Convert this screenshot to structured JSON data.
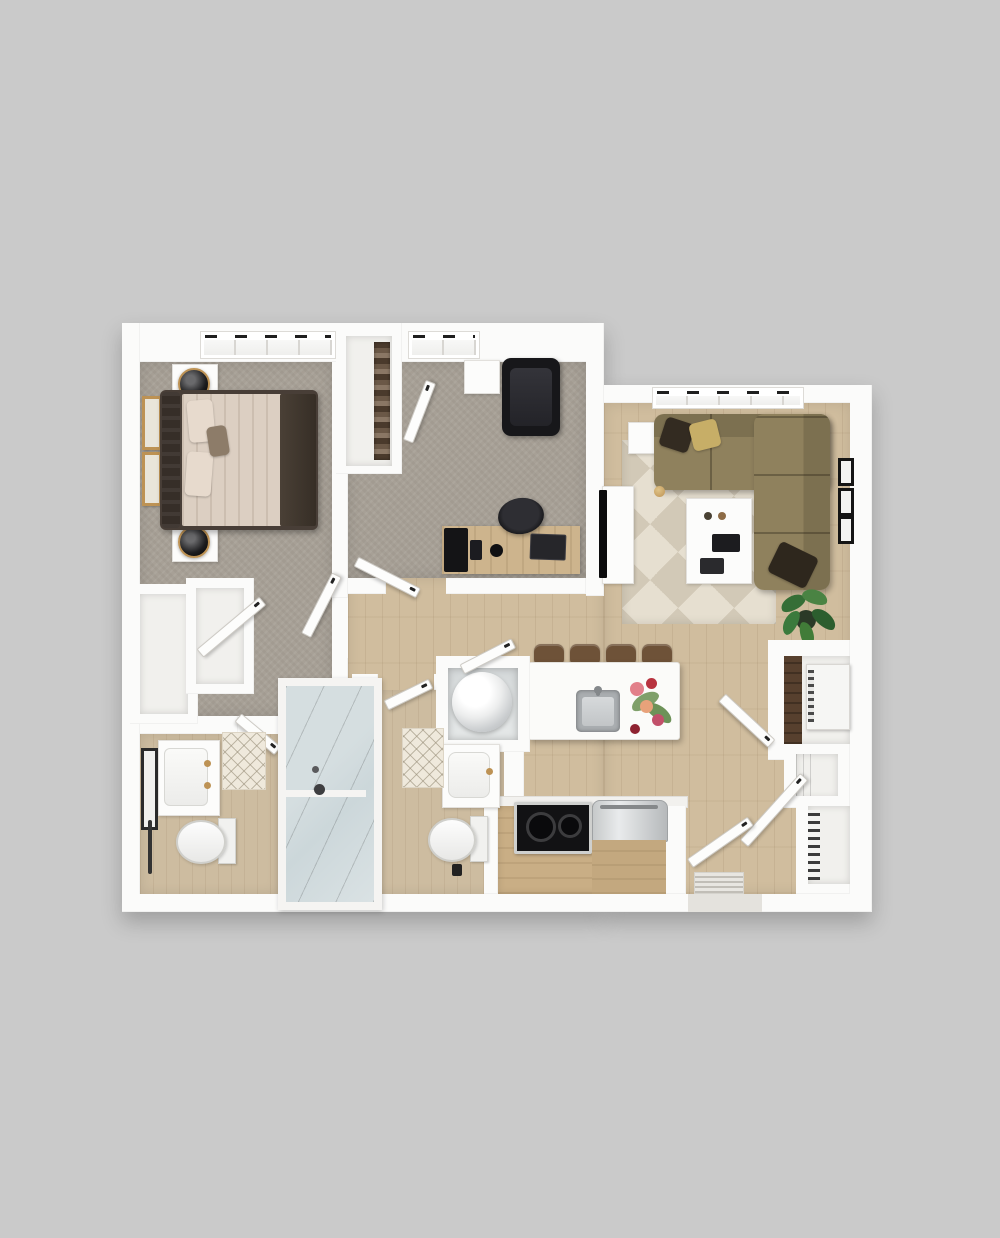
{
  "scene": {
    "description": "3D top-down rendering of a two-bedroom apartment floor plan on a gray background",
    "background": "#cacaca"
  },
  "colors": {
    "bg": "#cacaca",
    "wall": "#fbfbfa",
    "carpet": "#a7a096",
    "wood": "#d0bd9e",
    "woodBath": "#cdbca0",
    "glass": "#ccd7da",
    "rugA": "#d2c9b7",
    "rugB": "#e6dfd0",
    "sofa": "#8f815d",
    "sofaBack": "#7c7050",
    "pillowGold": "#c7ae67",
    "pillowDark": "#332b21",
    "bedFrame": "#483e37",
    "duvet": "#dccfc2",
    "pillow": "#e7dacd",
    "gold": "#bd9254",
    "dark": "#17171a",
    "steel": "#c3c6c8",
    "woodFurn": "#cdb48d",
    "stool": "#6e5238",
    "cabinetWood": "#c9ae85",
    "plant": "#3b7a3c",
    "doorFace": "#fdfdfc",
    "doorEdge": "#cdcac4",
    "interiorCloset": "#f1f0ed"
  },
  "rooms": [
    {
      "id": "bedroom",
      "name": "Bedroom",
      "floor": "carpet"
    },
    {
      "id": "office",
      "name": "Office / Bedroom 2",
      "floor": "carpet"
    },
    {
      "id": "living-room",
      "name": "Living Room",
      "floor": "hardwood"
    },
    {
      "id": "kitchen",
      "name": "Kitchen",
      "floor": "hardwood"
    },
    {
      "id": "hallway",
      "name": "Hallway",
      "floor": "hardwood"
    },
    {
      "id": "bathroom-1",
      "name": "Bathroom 1",
      "floor": "hardwood"
    },
    {
      "id": "bathroom-2",
      "name": "Bathroom 2",
      "floor": "hardwood"
    },
    {
      "id": "shower",
      "name": "Walk-in Shower",
      "floor": "glass-enclosure"
    },
    {
      "id": "laundry-closet",
      "name": "Laundry Closet",
      "floor": "hardwood"
    },
    {
      "id": "entry",
      "name": "Entry",
      "floor": "hardwood"
    },
    {
      "id": "closets",
      "name": "Closets & Storage",
      "floor": "hardwood"
    }
  ],
  "furniture": [
    {
      "room": "bedroom",
      "items": [
        "queen-bed",
        "headboard",
        "nightstand x2",
        "table-lamp x2",
        "wall-art x2",
        "window"
      ]
    },
    {
      "room": "office",
      "items": [
        "lounge-chair",
        "side-table",
        "desk",
        "desk-chair",
        "laptop",
        "wardrobe-shelving",
        "window"
      ]
    },
    {
      "room": "living-room",
      "items": [
        "sectional-sofa",
        "throw-pillows",
        "geometric-rug",
        "coffee-table",
        "remotes",
        "side-table",
        "tv",
        "tv-console",
        "wall-frames x3",
        "potted-plant",
        "window"
      ]
    },
    {
      "room": "kitchen",
      "items": [
        "island",
        "sink",
        "flowers",
        "bar-stool x4",
        "cooktop",
        "refrigerator",
        "cabinets"
      ]
    },
    {
      "room": "bathroom-1",
      "items": [
        "vanity",
        "mirror",
        "toilet",
        "towel-bar",
        "bath-mat"
      ]
    },
    {
      "room": "bathroom-2",
      "items": [
        "vanity",
        "toilet",
        "bath-mat",
        "waste-bin"
      ]
    },
    {
      "room": "laundry-closet",
      "items": [
        "washer"
      ]
    },
    {
      "room": "closets",
      "items": [
        "utility-appliance",
        "shelf-niche",
        "linen-towels"
      ]
    },
    {
      "room": "entry",
      "items": [
        "entry-door",
        "doormat"
      ]
    }
  ]
}
